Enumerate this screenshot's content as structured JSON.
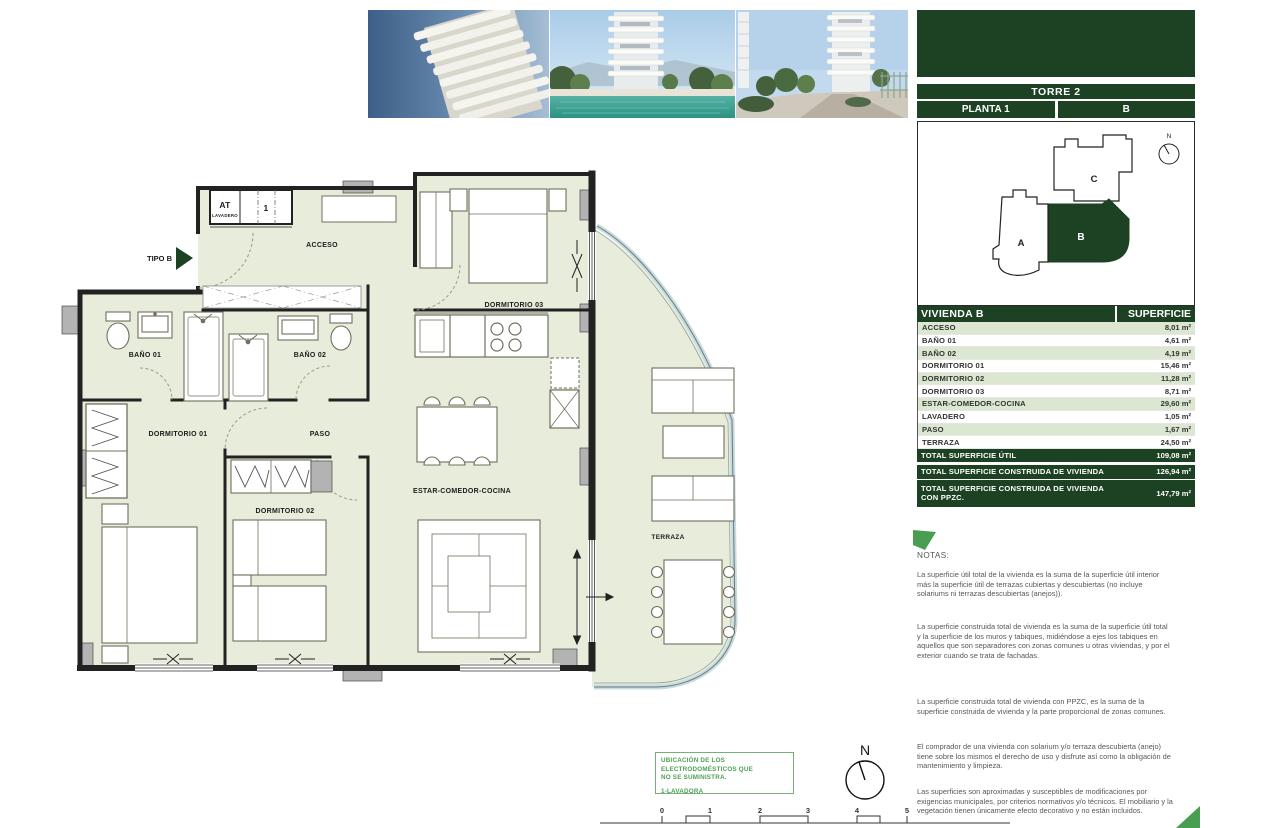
{
  "colors": {
    "dark_green": "#1d4223",
    "row_green": "#dbe7d0",
    "plan_fill": "#e7ecdb",
    "accent_green": "#4a9e52",
    "note_text": "#575757"
  },
  "panel": {
    "tower": "TORRE 2",
    "floor": "PLANTA 1",
    "unit": "B",
    "keyplan": {
      "unit_a": "A",
      "unit_b": "B",
      "unit_c": "C",
      "north": "N"
    },
    "table": {
      "title": "VIVIENDA B",
      "area_header": "SUPERFICIE",
      "rows": [
        {
          "label": "ACCESO",
          "value": "8,01 m²"
        },
        {
          "label": "BAÑO 01",
          "value": "4,61 m²"
        },
        {
          "label": "BAÑO 02",
          "value": "4,19 m²"
        },
        {
          "label": "DORMITORIO 01",
          "value": "15,46 m²"
        },
        {
          "label": "DORMITORIO 02",
          "value": "11,28 m²"
        },
        {
          "label": "DORMITORIO 03",
          "value": "8,71 m²"
        },
        {
          "label": "ESTAR-COMEDOR-COCINA",
          "value": "29,60 m²"
        },
        {
          "label": "LAVADERO",
          "value": "1,05 m²"
        },
        {
          "label": "PASO",
          "value": "1,67 m²"
        },
        {
          "label": "TERRAZA",
          "value": "24,50 m²"
        }
      ],
      "total_util": {
        "label": "TOTAL SUPERFICIE ÚTIL",
        "value": "109,08 m²"
      },
      "total_construida": {
        "label": "TOTAL SUPERFICIE CONSTRUIDA DE VIVIENDA",
        "value": "126,94 m²"
      },
      "total_ppzc": {
        "label": "TOTAL SUPERFICIE CONSTRUIDA DE VIVIENDA CON PPZC.",
        "value": "147,79 m²"
      }
    },
    "notes": {
      "heading": "NOTAS:",
      "paragraphs": [
        "La superficie útil total de la vivienda es la suma de la superficie útil interior más la superficie útil de terrazas cubiertas y descubiertas (no incluye solariums ni terrazas descubiertas (anejos)).",
        "La superficie construida total de vivienda es la suma de la superficie útil total y la superficie de los muros y tabiques, midiéndose a ejes los tabiques en aquellos que son separadores con zonas comunes u otras viviendas, y por el exterior cuando se trata de fachadas.",
        "La superficie construida total de vivienda con PPZC, es la suma de la superficie construida de vivienda y la parte proporcional de zonas comunes.",
        "El comprador de una vivienda con solarium y/o terraza descubierta (anejo) tiene sobre los mismos el derecho de uso y disfrute así como la obligación de mantenimiento y limpieza.",
        "Las superficies son aproximadas y susceptibles de modificaciones por exigencias municipales, por criterios normativos y/o técnicos. El mobiliario y la vegetación tienen únicamente efecto decorativo y no están incluidos."
      ]
    }
  },
  "plan": {
    "type_label": "TIPO B",
    "rooms": {
      "acceso": "ACCESO",
      "bano01": "BAÑO 01",
      "bano02": "BAÑO 02",
      "dorm01": "DORMITORIO 01",
      "dorm02": "DORMITORIO 02",
      "dorm03": "DORMITORIO 03",
      "paso": "PASO",
      "estar": "ESTAR-COMEDOR-COCINA",
      "terraza": "TERRAZA"
    },
    "utility": {
      "at": "AT",
      "lavadero": "LAVADERO",
      "number": "1"
    }
  },
  "legend": {
    "line1": "UBICACIÓN DE LOS ELECTRODOMÉSTICOS QUE",
    "line2": "NO SE SUMINISTRA.",
    "item": "1-LAVADORA"
  },
  "compass": {
    "north": "N"
  },
  "scalebar": {
    "ticks": [
      "0",
      "1",
      "2",
      "3",
      "4",
      "5"
    ]
  }
}
